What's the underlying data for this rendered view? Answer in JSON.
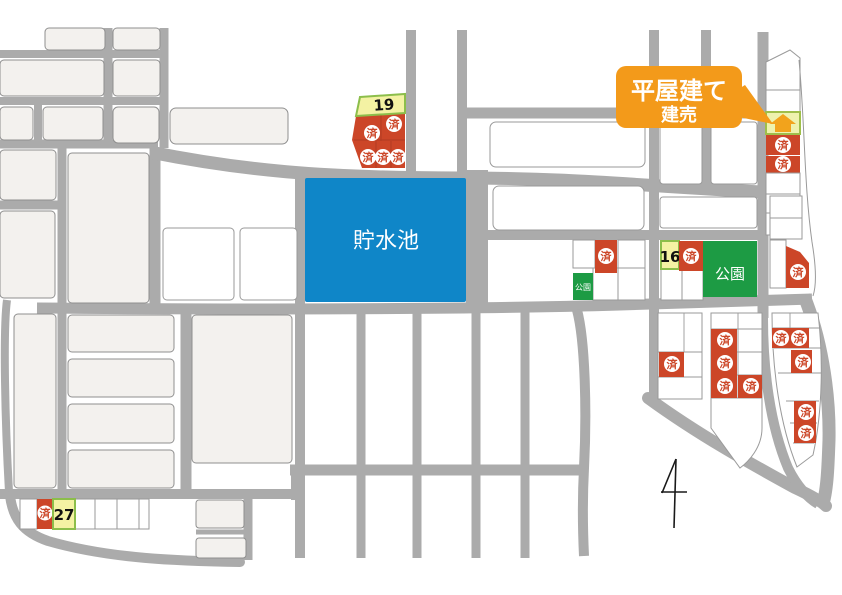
{
  "labels": {
    "sold": "済",
    "reservoir": "貯水池",
    "park": "公園",
    "park_small": "公園"
  },
  "callout": {
    "line1": "平屋建て",
    "line2": "建売"
  },
  "lots": {
    "lot19": "19",
    "lot16": "16",
    "lot27": "27"
  },
  "colors": {
    "road_gray": "#ababab",
    "block_offwhite": "#f3f1ee",
    "lot_outline": "#9a9a9a",
    "sold_red": "#cc4628",
    "reservoir_blue": "#0f86c8",
    "park_green": "#1d9b44",
    "lot_yellow": "#f4f2a3",
    "lot_yellow_border": "#8cbe4b",
    "callout_orange": "#f39a1a",
    "house_orange": "#f2a31c",
    "north_arrow_black": "#1a1a1a"
  }
}
